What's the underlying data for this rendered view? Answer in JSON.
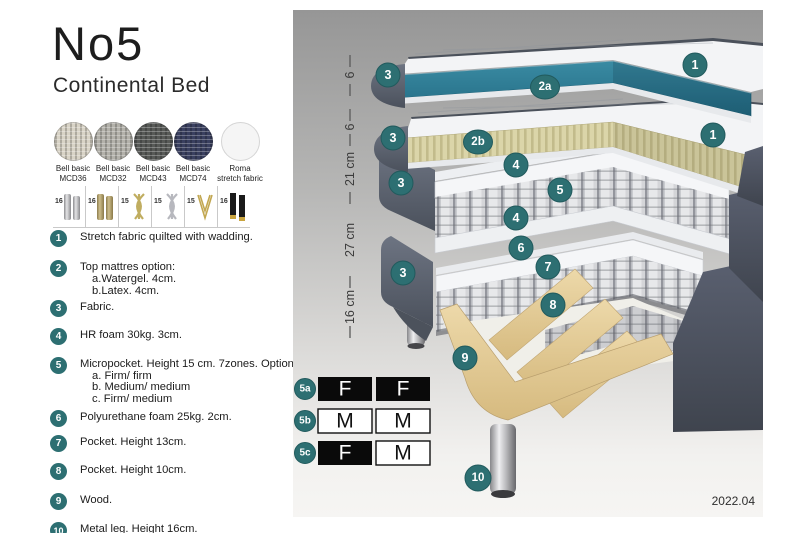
{
  "header": {
    "title": "No5",
    "subtitle": "Continental Bed"
  },
  "swatches": [
    {
      "line1": "Bell basic",
      "line2": "MCD36",
      "color": "#d8d3c6"
    },
    {
      "line1": "Bell basic",
      "line2": "MCD32",
      "color": "#b3b1aa"
    },
    {
      "line1": "Bell basic",
      "line2": "MCD43",
      "color": "#585a57"
    },
    {
      "line1": "Bell basic",
      "line2": "MCD74",
      "color": "#3a4060"
    },
    {
      "line1": "Roma",
      "line2": "stretch fabric",
      "color": "#f5f5f5"
    }
  ],
  "leg_options": [
    {
      "height": "16",
      "type": "cylinder-silver"
    },
    {
      "height": "16",
      "type": "cylinder-gold"
    },
    {
      "height": "15",
      "type": "cross-gold"
    },
    {
      "height": "15",
      "type": "cross-silver"
    },
    {
      "height": "15",
      "type": "hairpin-gold"
    },
    {
      "height": "16",
      "type": "black-gold"
    }
  ],
  "legend": [
    {
      "num": "1",
      "text": "Stretch fabric quilted with wadding."
    },
    {
      "num": "2",
      "text": "Top mattres option:",
      "subs": [
        "a.Watergel. 4cm.",
        "b.Latex. 4cm."
      ]
    },
    {
      "num": "3",
      "text": "Fabric."
    },
    {
      "num": "4",
      "text": "HR foam 30kg. 3cm."
    },
    {
      "num": "5",
      "text": "Micropocket. Height 15 cm. 7zones. Option:",
      "subs": [
        "a. Firm/ firm",
        "b. Medium/ medium",
        "c. Firm/ medium"
      ]
    },
    {
      "num": "6",
      "text": "Polyurethane foam 25kg. 2cm."
    },
    {
      "num": "7",
      "text": "Pocket. Height 13cm."
    },
    {
      "num": "8",
      "text": "Pocket. Height 10cm."
    },
    {
      "num": "9",
      "text": "Wood."
    },
    {
      "num": "10",
      "text": "Metal leg. Height 16cm."
    }
  ],
  "diagram": {
    "ruler": [
      "6",
      "6",
      "21 cm",
      "27 cm",
      "16 cm"
    ],
    "badges": {
      "b1": "1",
      "b2a": "2a",
      "b2b": "2b",
      "b3": "3",
      "b4": "4",
      "b5": "5",
      "b6": "6",
      "b7": "7",
      "b8": "8",
      "b9": "9",
      "b10": "10"
    }
  },
  "firmness_table": {
    "rows": [
      {
        "id": "5a",
        "cells": [
          {
            "letter": "F",
            "variant": "dark"
          },
          {
            "letter": "F",
            "variant": "dark"
          }
        ]
      },
      {
        "id": "5b",
        "cells": [
          {
            "letter": "M",
            "variant": "light"
          },
          {
            "letter": "M",
            "variant": "light"
          }
        ]
      },
      {
        "id": "5c",
        "cells": [
          {
            "letter": "F",
            "variant": "dark"
          },
          {
            "letter": "M",
            "variant": "light"
          }
        ]
      }
    ]
  },
  "footer": {
    "version": "2022.04"
  },
  "colors": {
    "badge_teal": "#2d6f72",
    "core_teal": "#2b7e95",
    "fabric_slate": "#5b6270",
    "latex_cream": "#d9d3a7",
    "wood": "#e7d4a4"
  }
}
